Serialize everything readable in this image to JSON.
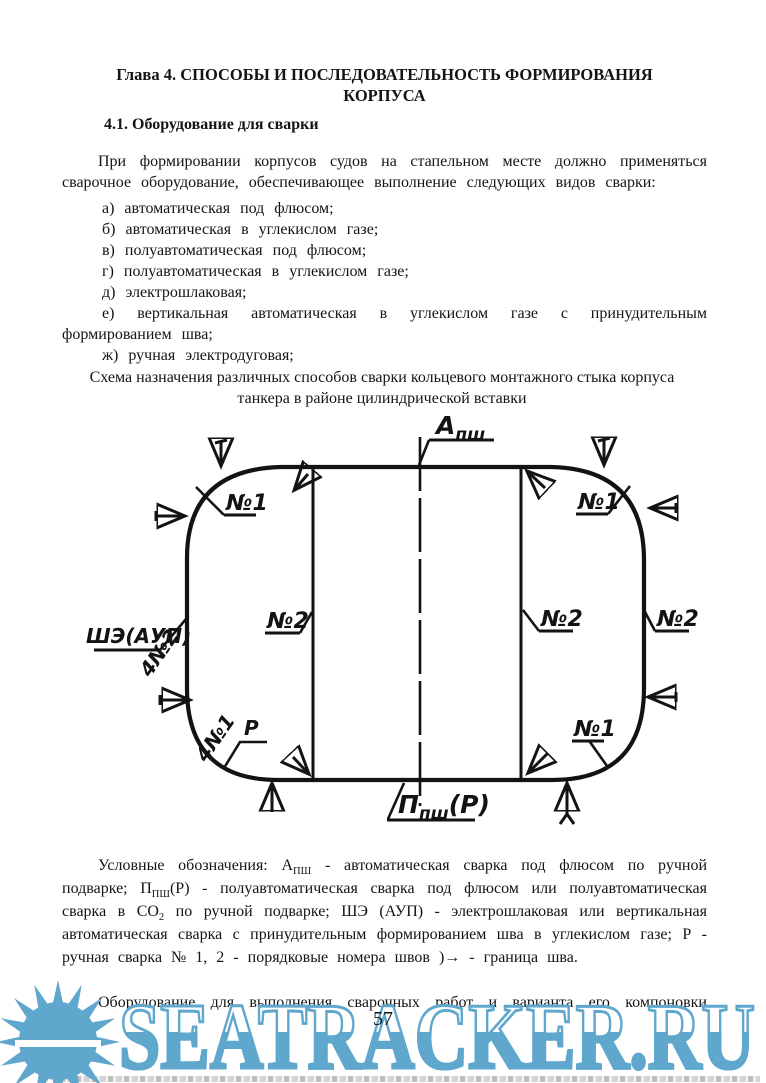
{
  "page": {
    "title_line1": "Глава 4. СПОСОБЫ И ПОСЛЕДОВАТЕЛЬНОСТЬ ФОРМИРОВАНИЯ",
    "title_line2": "КОРПУСА",
    "page_number": "57"
  },
  "section": {
    "heading": "4.1. Оборудование для сварки",
    "intro": "При формировании корпусов судов на стапельном месте должно применяться сварочное оборудование, обеспечивающее выполнение следующих видов сварки:",
    "welding_types": [
      "а) автоматическая под флюсом;",
      "б) автоматическая в углекислом газе;",
      "в) полуавтоматическая под флюсом;",
      "г) полуавтоматическая в углекислом газе;",
      "д) электрошлаковая;",
      "е) вертикальная автоматическая в углекислом газе с принудительным формированием шва;",
      "ж) ручная электродуговая;"
    ]
  },
  "figure": {
    "caption": "Схема назначения различных способов сварки кольцевого монтажного стыка корпуса танкера в районе цилиндрической вставки",
    "labels": {
      "a_main": "А",
      "a_sub": "пш",
      "p_main": "П",
      "p_sub": "пш",
      "p_tail": "(Р)",
      "she_aup": "ШЭ(АУП)",
      "no1": "№1",
      "no2": "№2",
      "n4no2": "4№2",
      "n4no1": "4№1",
      "r": "Р"
    }
  },
  "legend": {
    "p1": "Условные обозначения: А",
    "s1": "ПШ",
    "p2": " - автоматическая сварка под флюсом по ручной подварке; П",
    "s2": "ПШ",
    "p3": "(Р) - полуавтоматическая сварка под флюсом или полуавтоматическая сварка в СО",
    "s3": "2",
    "p4": " по ручной подварке; ШЭ (АУП) - электрошлаковая или вертикальная автоматическая сварка с принудительным формированием шва в углекислом газе; Р - ручная сварка № 1, 2 - порядковые номера швов )→ - граница шва."
  },
  "next_paragraph": {
    "first_line": "Оборудование для выполнения сварочных работ и варианта его компоновки"
  },
  "watermark": {
    "text": "SEATRACKER.RU",
    "color": "#5fa7cd"
  }
}
